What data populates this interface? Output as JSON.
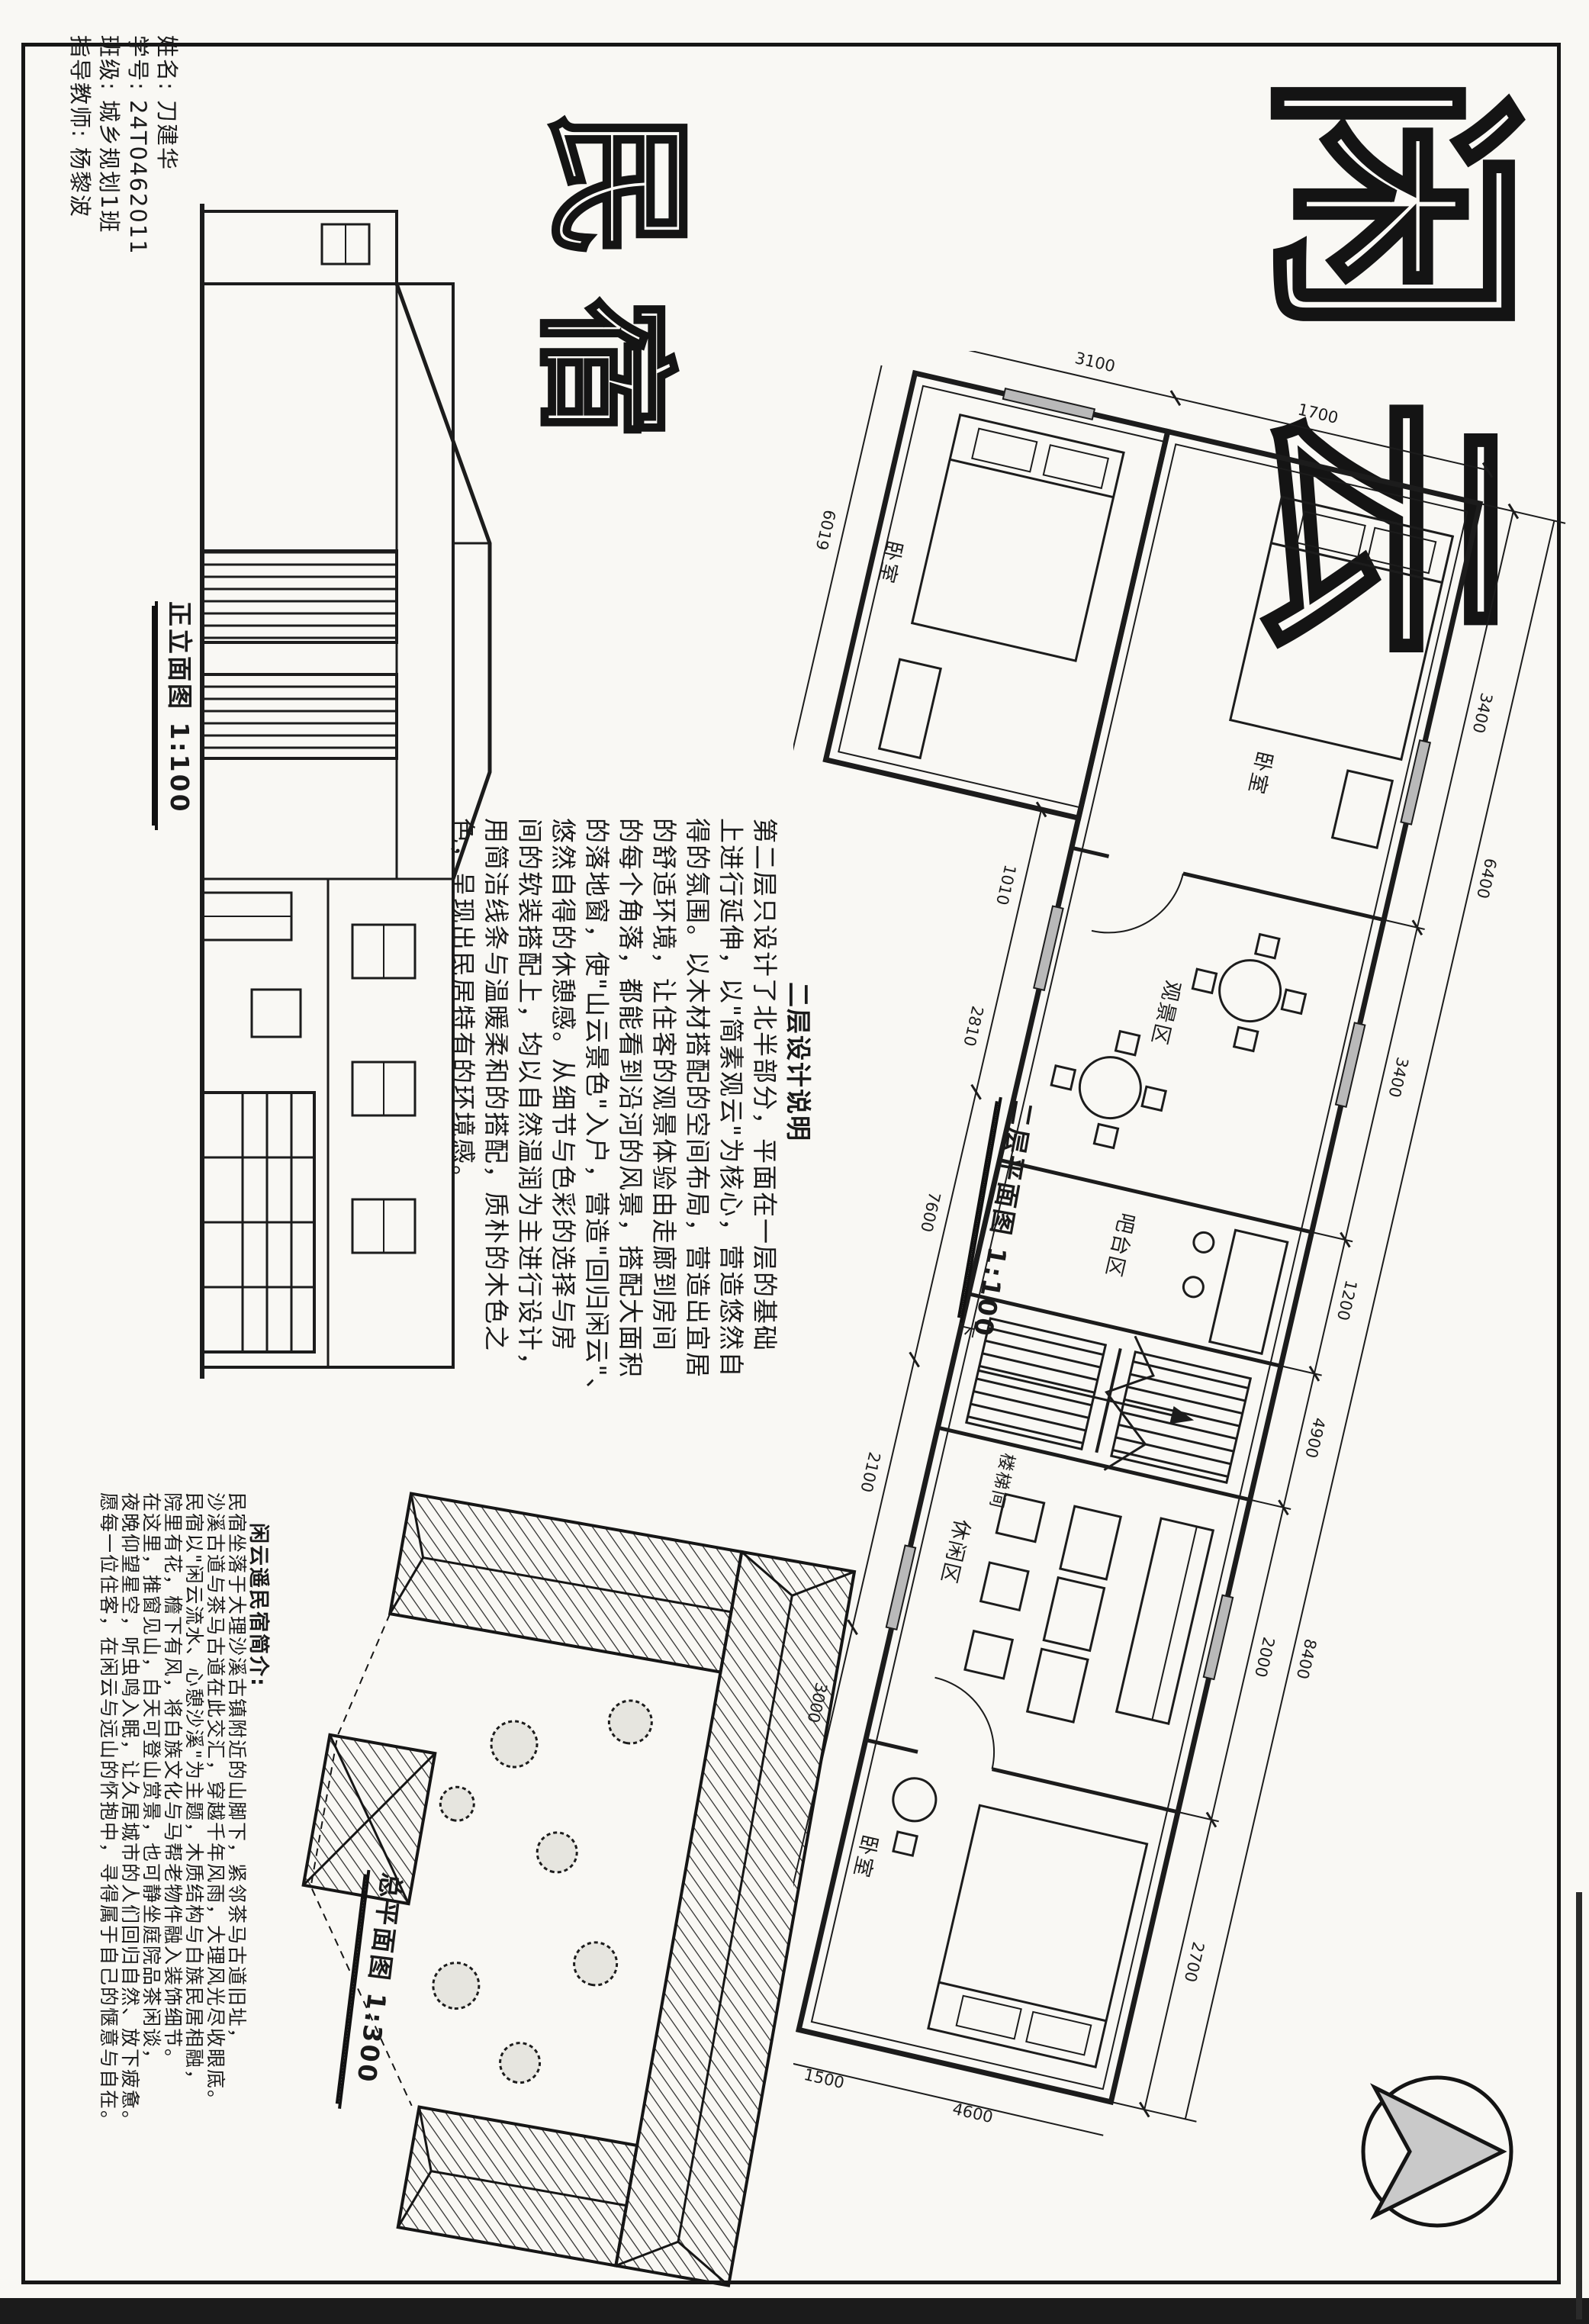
{
  "student_info": {
    "name_line": "姓名: 刀建华",
    "id_line": "学号: 24T0462011",
    "class_line": "班级: 城乡规划1班",
    "advisor_line": "指导教师: 杨黎波"
  },
  "title": {
    "char1": "闲",
    "char2": "云",
    "char3": "民",
    "char4": "宿"
  },
  "elevation": {
    "label": "正立面图 1:100"
  },
  "plan": {
    "label": "二层平面图 1:100",
    "rooms": [
      "卧室",
      "卧室",
      "观景区",
      "吧台区",
      "楼梯间",
      "休闲区",
      "卧室"
    ],
    "stair_down_label": "下",
    "dims_top": [
      "3400",
      "3400",
      "1200",
      "4900",
      "2000",
      "2700"
    ],
    "dims_top_outer": [
      "6400",
      "8400"
    ],
    "dims_bottom": [
      "1010",
      "2810",
      "7600",
      "2100",
      "3000",
      "2700"
    ],
    "dims_wing": [
      "1700",
      "3100",
      "3400"
    ],
    "dims_end": [
      "4600",
      "1500"
    ],
    "dims_bottom_outer": [
      "6019"
    ]
  },
  "design_notes": {
    "heading": "二层设计说明",
    "lines": [
      "第二层只设计了北半部分，平面在一层的基础",
      "上进行延伸，以\"简素观云\"为核心，营造悠然自",
      "得的氛围。以木材搭配的空间布局，营造出宜居",
      "的舒适环境，让住客的观景体验由走廊到房间",
      "的每个角落，都能看到沿河的风景，搭配大面积",
      "的落地窗，使\"山云景色\"入户，营造\"回归闲云\"、",
      "悠然自得的休憩感。从细节与色彩的选择与房",
      "间的软装搭配上，均以自然温润为主进行设计，",
      "用简洁线条与温暖柔和的搭配，质朴的木色之",
      "色，呈现出民居特有的环境感。"
    ]
  },
  "site_plan": {
    "label": "总平面图 1:300"
  },
  "intro": {
    "heading": "闲云遥民宿简介:",
    "lines": [
      "民宿坐落于大理沙溪古镇附近的山脚下，紧邻茶马古道旧址，",
      "沙溪古道与茶马古道在此交汇，穿越千年风雨，大理风光尽收眼底。",
      "民宿以\"闲云流水、心憩沙溪\"为主题，木质结构与白族民居相融，",
      "院里有花，檐下有风，将白族文化与马帮老物件融入装饰细节。",
      "在这里，推窗见山，白天可登山赏景，也可静坐庭院品茶闲谈，",
      "夜晚仰望星空，听虫鸣入眠，让久居城市的人们回归自然、放下疲惫。",
      "愿每一位住客，在闲云与远山的怀抱中，寻得属于自己的惬意与自在。"
    ]
  },
  "colors": {
    "ink": "#1c1c1c",
    "paper": "#f9f8f4",
    "glass_gray": "#b9b9b9",
    "arrow_gray": "#c9c9c9"
  }
}
